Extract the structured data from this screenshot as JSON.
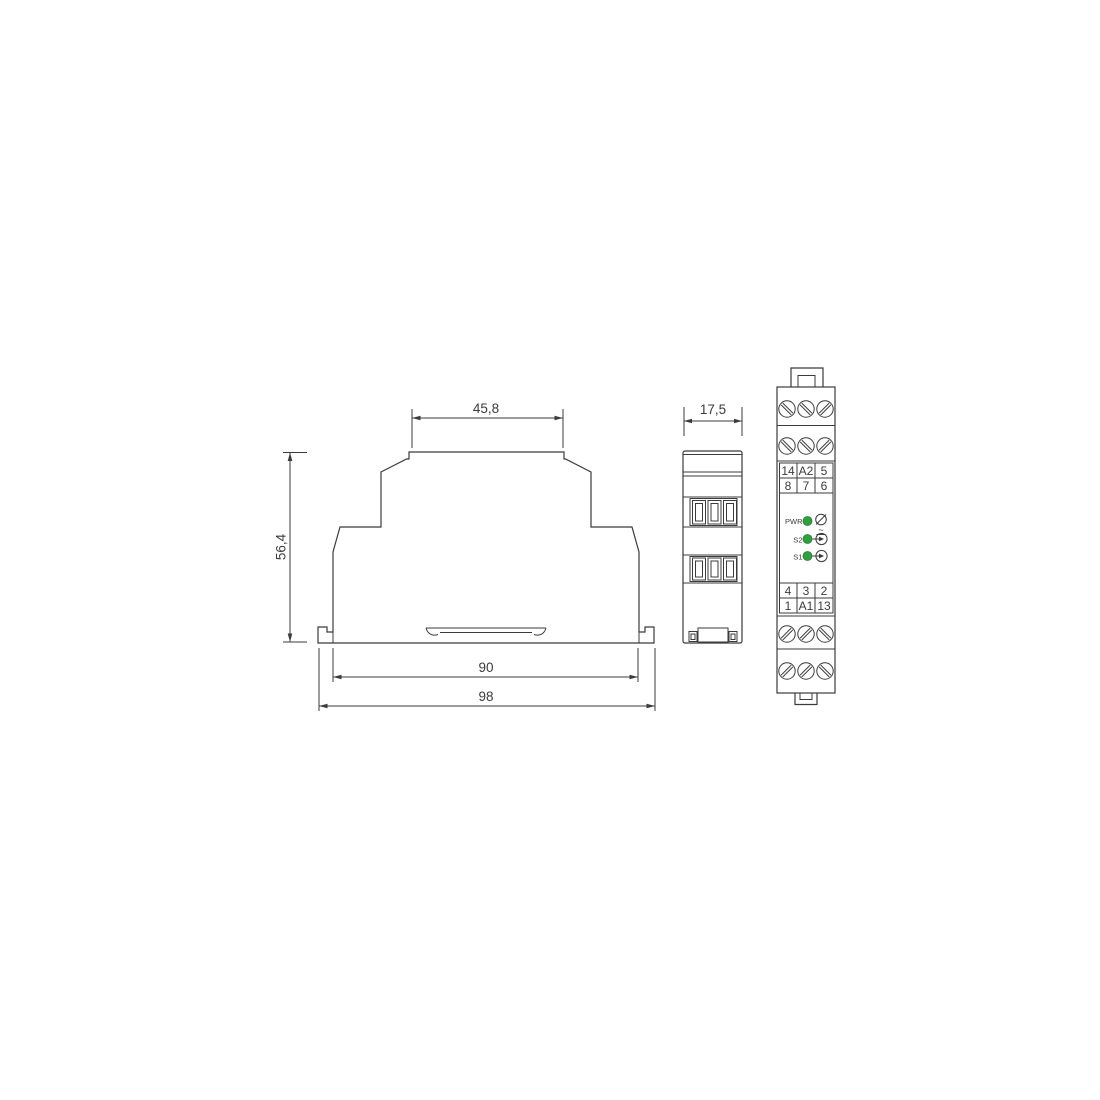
{
  "drawing": {
    "type": "technical-dimension-drawing",
    "subject": "DIN-rail relay module, three orthographic views",
    "colors": {
      "line": "#3b3b3b",
      "led_green": "#2aa33c",
      "background": "#ffffff"
    },
    "dimensions": {
      "cap_width": "45,8",
      "height": "56,4",
      "body_width": "90",
      "overall_width": "98",
      "depth": "17,5"
    },
    "front_panel": {
      "top_table": {
        "rows": [
          [
            "14",
            "A2",
            "5"
          ],
          [
            "8",
            "7",
            "6"
          ]
        ]
      },
      "bottom_table": {
        "rows": [
          [
            "4",
            "3",
            "2"
          ],
          [
            "1",
            "A1",
            "13"
          ]
        ]
      },
      "leds": [
        {
          "label": "PWR",
          "symbol": "ac-supply-circle"
        },
        {
          "label": "S2",
          "symbol": "arrow-into-circle-input"
        },
        {
          "label": "S1",
          "symbol": "arrow-into-circle-input"
        }
      ],
      "supply_wave_mark": "~",
      "screw_rows": 4,
      "screws_per_row": 3
    },
    "icons": {
      "screw": "slotted-screw-head",
      "supply": "circle-with-slash-and-ac-wave",
      "input": "arrow-entering-circle"
    }
  }
}
